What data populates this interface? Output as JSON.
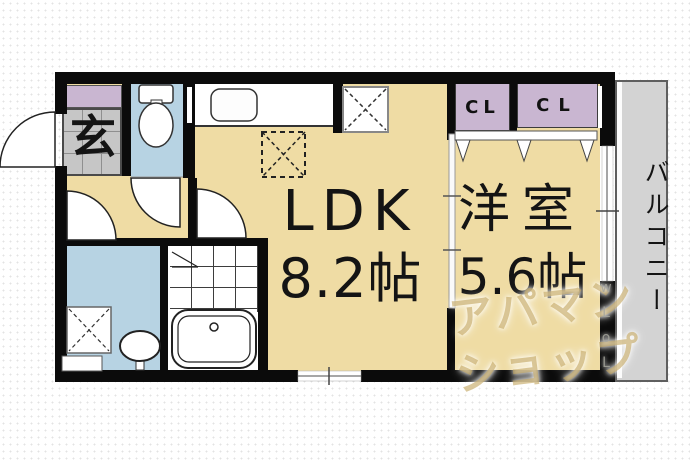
{
  "plan_title": "1LDK apartment floor plan",
  "rooms": {
    "ldk": {
      "label": "LDK",
      "size": "8.2帖"
    },
    "western": {
      "label": "洋室",
      "size": "5.6帖"
    },
    "entrance": {
      "label": "玄"
    },
    "closet_left": {
      "label": "CL"
    },
    "closet_right": {
      "label": "CL"
    },
    "balcony": {
      "label": "バルコニー"
    }
  },
  "watermark": {
    "line1": "アパマン",
    "line2": "ショップ",
    "side_fragment": "wLoL"
  },
  "colors": {
    "floor_tan": "#EFDCA4",
    "water_room_blue": "#B7D3E3",
    "closet_lavender": "#C9B6D1",
    "entrance_tile_gray": "#C6C6C6",
    "balcony_gray": "#D3D3D3",
    "wall_black": "#0B0B0B",
    "watermark_tan": "#C1A35C"
  }
}
